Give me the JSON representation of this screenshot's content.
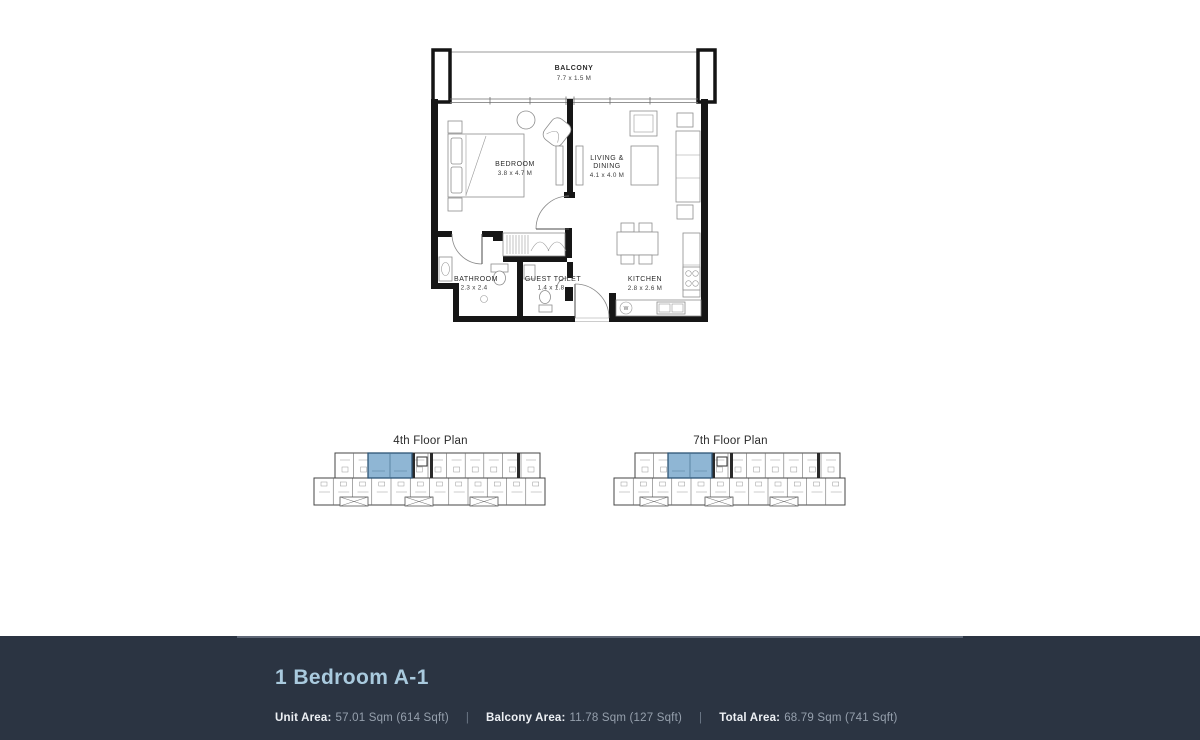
{
  "plan": {
    "balcony": {
      "name": "BALCONY",
      "dims": "7.7 x 1.5 M"
    },
    "bedroom": {
      "name": "BEDROOM",
      "dims": "3.8 x 4.7 M"
    },
    "living": {
      "name_line1": "LIVING &",
      "name_line2": "DINING",
      "dims": "4.1 x 4.0 M"
    },
    "bathroom": {
      "name": "BATHROOM",
      "dims": "2.3 x 2.4"
    },
    "guest_toilet": {
      "name": "GUEST TOILET",
      "dims": "1.4 x 1.8"
    },
    "kitchen": {
      "name": "KITCHEN",
      "dims": "2.8 x 2.6 M"
    },
    "washer_label": "W"
  },
  "floor_thumbnails": [
    {
      "label": "4th Floor Plan"
    },
    {
      "label": "7th Floor Plan"
    }
  ],
  "footer": {
    "title": "1 Bedroom A-1",
    "separator": "|",
    "areas": [
      {
        "label": "Unit Area:",
        "value": "57.01 Sqm (614 Sqft)"
      },
      {
        "label": "Balcony Area:",
        "value": "11.78 Sqm (127 Sqft)"
      },
      {
        "label": "Total Area:",
        "value": "68.79 Sqm (741 Sqft)"
      }
    ]
  },
  "colors": {
    "footer_background": "#2b3442",
    "title_text": "#a9cade",
    "area_label": "#edf0f4",
    "area_value": "#96a0ad",
    "separator": "#6e7988",
    "highlight_unit": "#8fb6d4",
    "plan_wall": "#161616"
  }
}
